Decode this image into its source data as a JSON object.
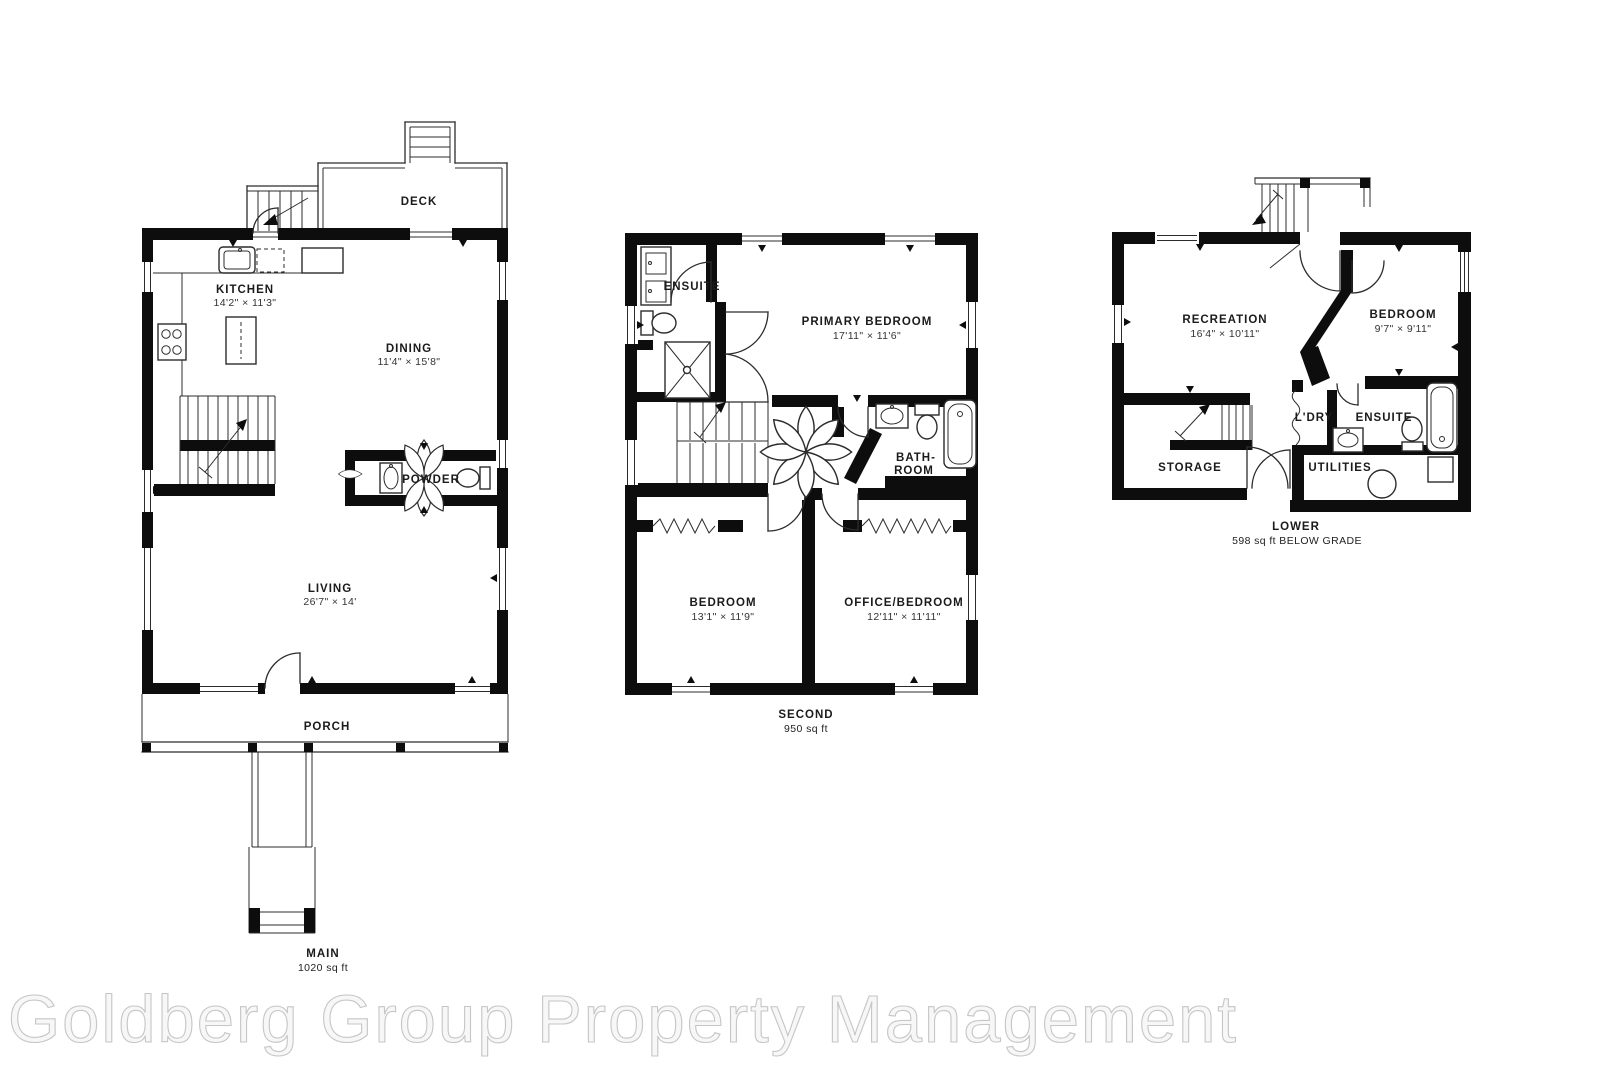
{
  "watermark": "Goldberg Group Property Management",
  "main": {
    "floor_label": "MAIN",
    "floor_area": "1020 sq ft",
    "deck_label": "DECK",
    "porch_label": "PORCH",
    "kitchen_label": "KITCHEN",
    "kitchen_dims": "14'2\" × 11'3\"",
    "dining_label": "DINING",
    "dining_dims": "11'4\" × 15'8\"",
    "powder_label": "POWDER",
    "living_label": "LIVING",
    "living_dims": "26'7\" × 14'"
  },
  "second": {
    "floor_label": "SECOND",
    "floor_area": "950 sq ft",
    "ensuite_label": "ENSUITE",
    "primary_bedroom_label": "PRIMARY BEDROOM",
    "primary_bedroom_dims": "17'11\" × 11'6\"",
    "bathroom_label_line1": "BATH-",
    "bathroom_label_line2": "ROOM",
    "bedroom_label": "BEDROOM",
    "bedroom_dims": "13'1\" × 11'9\"",
    "office_bedroom_label": "OFFICE/BEDROOM",
    "office_bedroom_dims": "12'11\" × 11'11\""
  },
  "lower": {
    "floor_label": "LOWER",
    "floor_area": "598 sq ft BELOW GRADE",
    "recreation_label": "RECREATION",
    "recreation_dims": "16'4\" × 10'11\"",
    "bedroom_label": "BEDROOM",
    "bedroom_dims": "9'7\" × 9'11\"",
    "laundry_label": "L'DRY",
    "ensuite_label": "ENSUITE",
    "storage_label": "STORAGE",
    "utilities_label": "UTILITIES"
  }
}
